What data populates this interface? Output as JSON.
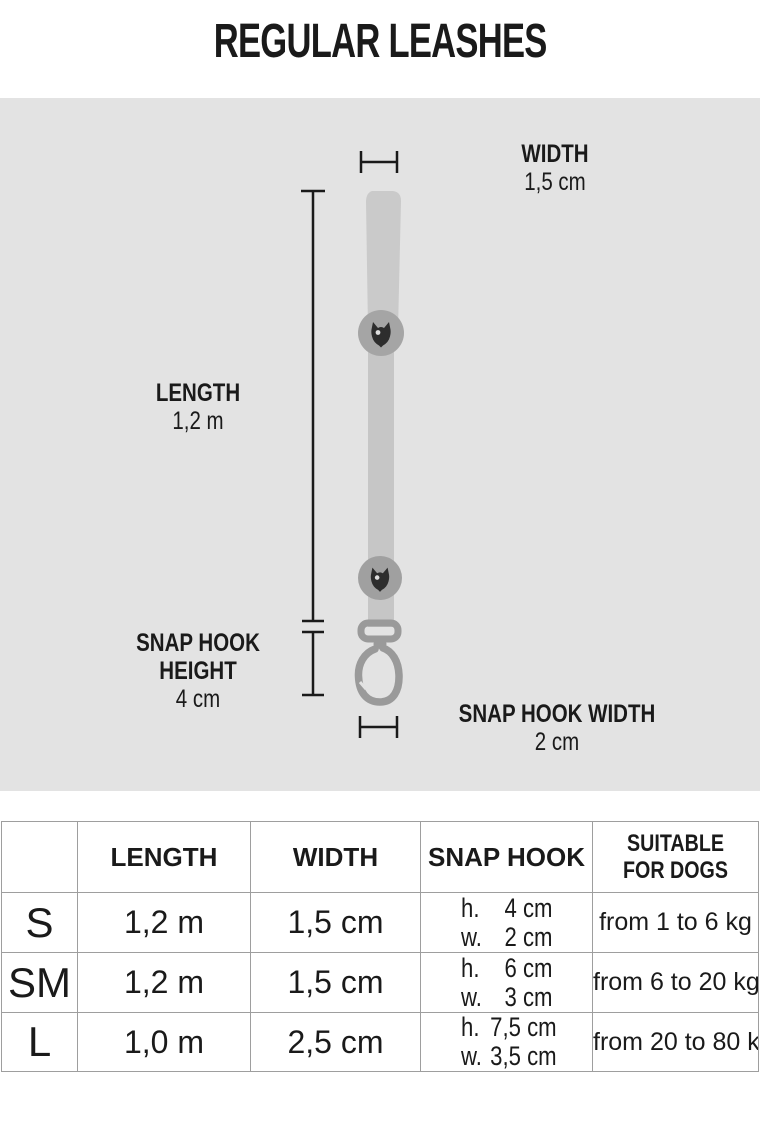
{
  "title": "REGULAR LEASHES",
  "diagram": {
    "width_label": "WIDTH",
    "width_value": "1,5 cm",
    "length_label": "LENGTH",
    "length_value": "1,2 m",
    "snap_hook_height_label_line1": "SNAP HOOK",
    "snap_hook_height_label_line2": "HEIGHT",
    "snap_hook_height_value": "4 cm",
    "snap_hook_width_label": "SNAP HOOK WIDTH",
    "snap_hook_width_value": "2 cm",
    "icons": {
      "badge_logo": "owl-logo-icon"
    },
    "colors": {
      "panel_background": "#e3e3e3",
      "leash_handle": "#cacaca",
      "leash_strap": "#c6c6c6",
      "badge": "#a5a5a5",
      "logo": "#2d2d2d",
      "snap_hook": "#9a9a9a",
      "measure_line": "#1a1a1a",
      "table_border": "#9e9e9e",
      "text": "#1a1a1a"
    }
  },
  "table": {
    "header_size": "",
    "header_length": "LENGTH",
    "header_width": "WIDTH",
    "header_snap_hook": "SNAP HOOK",
    "header_suitable_line1": "SUITABLE",
    "header_suitable_line2": "FOR DOGS",
    "rows": [
      {
        "size": "S",
        "length": "1,2 m",
        "width": "1,5 cm",
        "snap_hook": {
          "h_label": "h.",
          "h_value": "4 cm",
          "w_label": "w.",
          "w_value": "2 cm"
        },
        "suitable": "from 1 to 6 kg"
      },
      {
        "size": "SM",
        "length": "1,2 m",
        "width": "1,5 cm",
        "snap_hook": {
          "h_label": "h.",
          "h_value": "6 cm",
          "w_label": "w.",
          "w_value": "3 cm"
        },
        "suitable": "from 6 to 20 kg"
      },
      {
        "size": "L",
        "length": "1,0 m",
        "width": "2,5 cm",
        "snap_hook": {
          "h_label": "h.",
          "h_value": "7,5 cm",
          "w_label": "w.",
          "w_value": "3,5 cm"
        },
        "suitable": "from 20 to 80 kg"
      }
    ]
  }
}
